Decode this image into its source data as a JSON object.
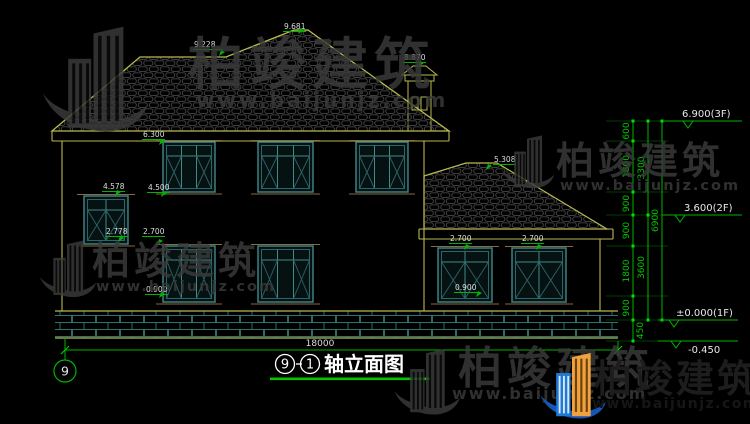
{
  "watermark": {
    "brand": "柏竣建筑",
    "url": "www.baijunjz.com"
  },
  "annotations": [
    {
      "id": "main-ridge",
      "text": "9.228"
    },
    {
      "id": "main-peak",
      "text": "9.681"
    },
    {
      "id": "chimney-top",
      "text": "8.870"
    },
    {
      "id": "2f-window-top",
      "text": "6.300"
    },
    {
      "id": "stair-window-top",
      "text": "4.578"
    },
    {
      "id": "2f-window-sill",
      "text": "4.500"
    },
    {
      "id": "stair-window-sill",
      "text": "2.778"
    },
    {
      "id": "1f-window-top",
      "text": "2.700"
    },
    {
      "id": "1f-window-sill",
      "text": "0.900"
    },
    {
      "id": "wing-roof-top",
      "text": "5.308"
    },
    {
      "id": "wing-window1-top",
      "text": "2.700"
    },
    {
      "id": "wing-window2-top",
      "text": "2.700"
    },
    {
      "id": "wing-window-sill",
      "text": "0.900"
    }
  ],
  "right_dims": {
    "segments": [
      "600",
      "1800",
      "900",
      "900",
      "1800",
      "900",
      "450"
    ],
    "subtotals": [
      "3300",
      "3600"
    ],
    "total": "6900",
    "levels": [
      "6.900(3F)",
      "3.600(2F)",
      "±0.000(1F)",
      "-0.450"
    ]
  },
  "plan": {
    "width_dim": "18000",
    "axis_bubble": "9"
  },
  "title": {
    "axis_start": "9",
    "axis_end": "1",
    "name": "轴立面图"
  }
}
